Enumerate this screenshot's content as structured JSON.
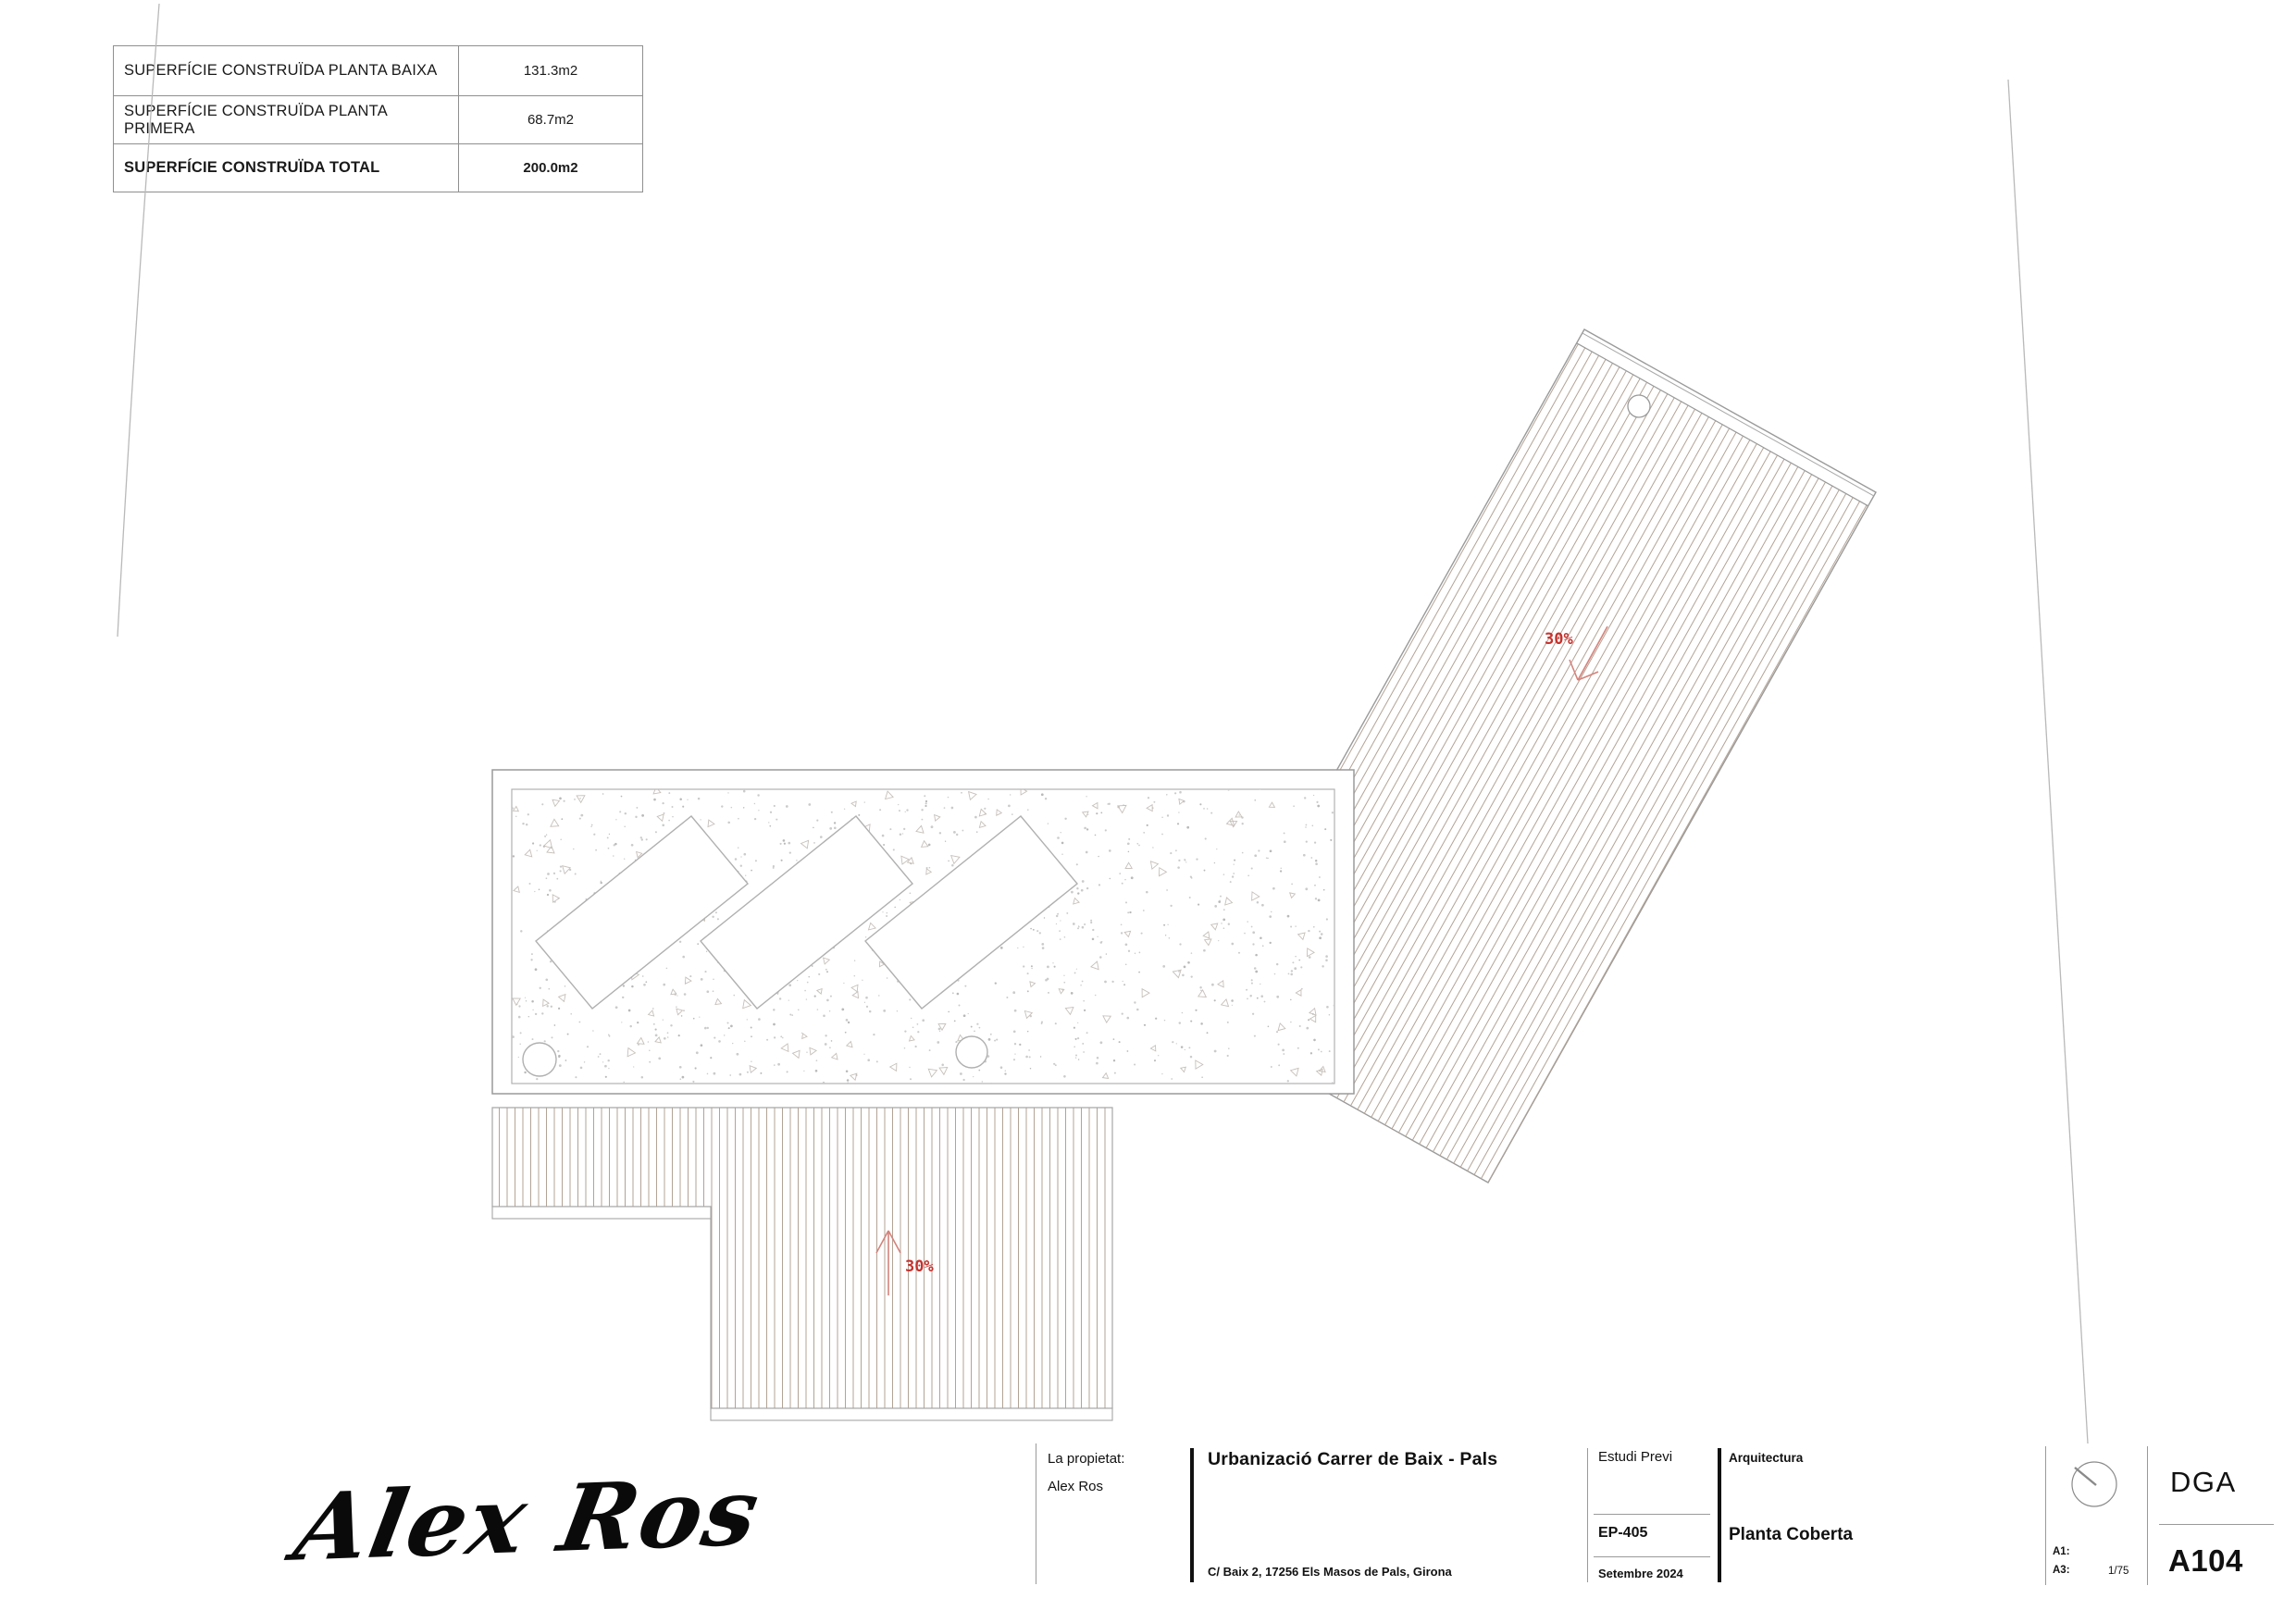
{
  "area_table": {
    "rows": [
      {
        "label": "SUPERFÍCIE CONSTRUÏDA PLANTA BAIXA",
        "value": "131.3m2"
      },
      {
        "label": "SUPERFÍCIE CONSTRUÏDA PLANTA PRIMERA",
        "value": "68.7m2"
      },
      {
        "label": "SUPERFÍCIE CONSTRUÏDA TOTAL",
        "value": "200.0m2"
      }
    ]
  },
  "drawing": {
    "roof_slope_label_upper": "30%",
    "roof_slope_label_lower": "30%",
    "colors": {
      "slope_red": "#c5332e",
      "slope_arrow": "#d4837b",
      "hatch": "#b3a396",
      "outline": "#9a9a9a"
    }
  },
  "signature": {
    "text": "Alex Ros"
  },
  "title_block": {
    "owner_label": "La propietat:",
    "owner_name": "Alex Ros",
    "project_title": "Urbanizació Carrer de Baix - Pals",
    "project_address": "C/ Baix 2, 17256 Els Masos de Pals, Girona",
    "phase_label": "Estudi Previ",
    "project_code": "EP-405",
    "date": "Setembre 2024",
    "discipline": "Arquitectura",
    "sheet_title": "Planta Coberta",
    "scale_a1_label": "A1:",
    "scale_a3_label": "A3:",
    "scale_value": "1/75",
    "firm": "DGA",
    "sheet_number": "A104"
  }
}
